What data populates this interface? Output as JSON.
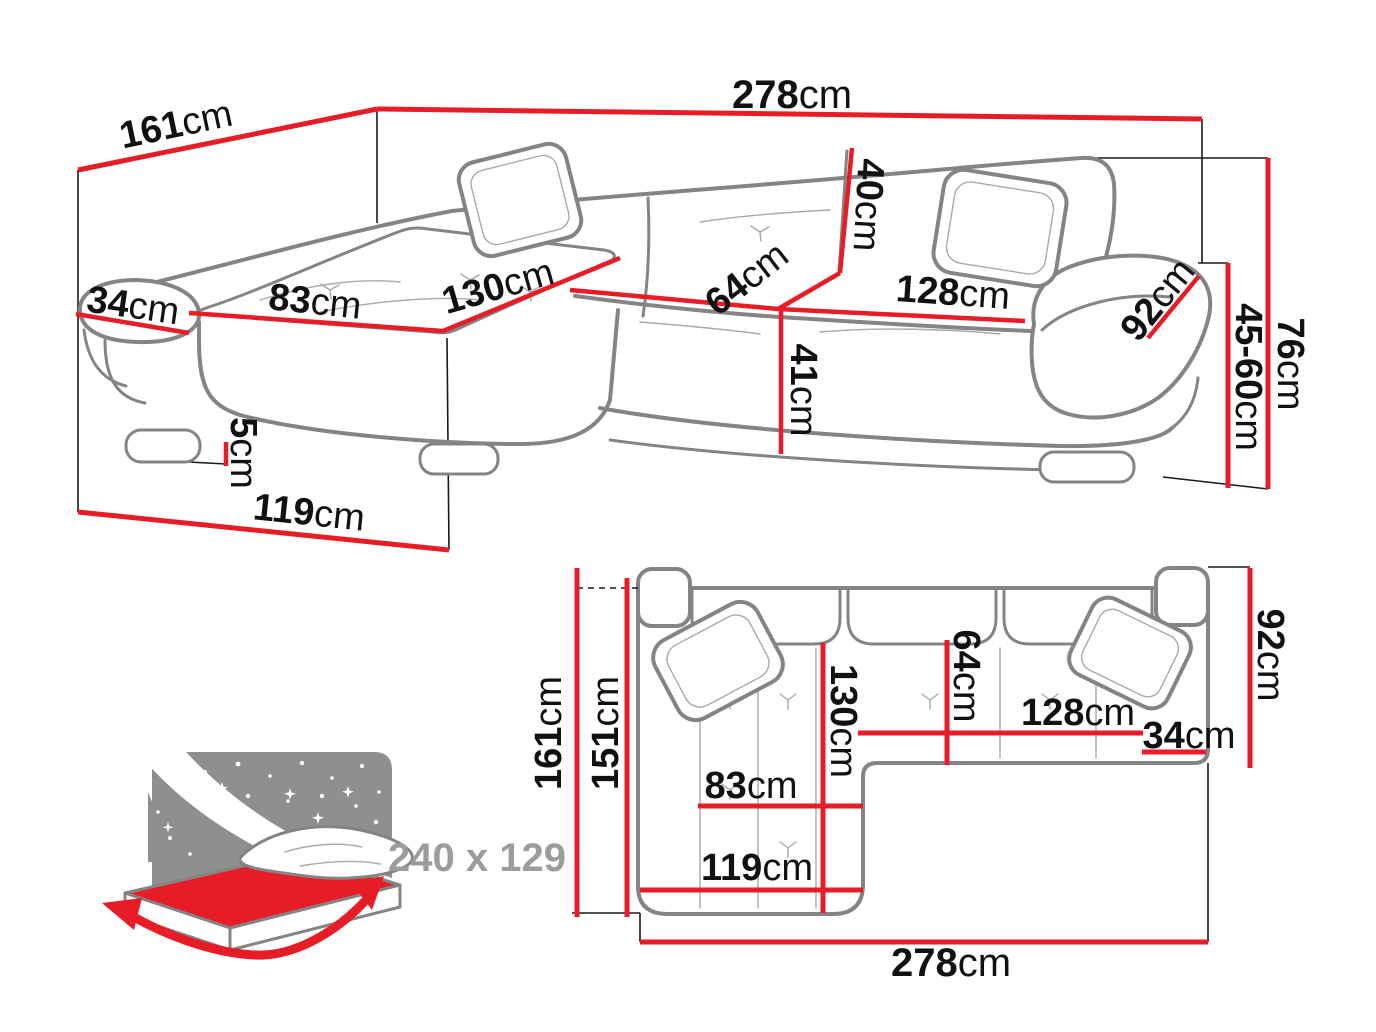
{
  "colors": {
    "dimension_red": "#e81c26",
    "sofa_outline_gray": "#848484",
    "detail_gray": "#a9a9a9",
    "line_black": "#1a1a1a",
    "label_black": "#111111",
    "icon_gray": "#8f8f8f",
    "icon_text_gray": "#9c9c9c",
    "background": "#ffffff"
  },
  "perspective_view": {
    "description": "corner sofa perspective drawing with dimensions",
    "dims": [
      {
        "id": "total-width",
        "value": "278",
        "unit": "cm"
      },
      {
        "id": "total-depth",
        "value": "161",
        "unit": "cm"
      },
      {
        "id": "armrest-width",
        "value": "34",
        "unit": "cm"
      },
      {
        "id": "chaise-seat-width",
        "value": "83",
        "unit": "cm"
      },
      {
        "id": "chaise-length",
        "value": "130",
        "unit": "cm"
      },
      {
        "id": "backrest-height",
        "value": "40",
        "unit": "cm"
      },
      {
        "id": "fold-depth",
        "value": "64",
        "unit": "cm"
      },
      {
        "id": "seat-width",
        "value": "128",
        "unit": "cm"
      },
      {
        "id": "armrest-length",
        "value": "92",
        "unit": "cm"
      },
      {
        "id": "total-height",
        "value": "76",
        "unit": "cm"
      },
      {
        "id": "seat-height-range",
        "value": "45-60",
        "unit": "cm"
      },
      {
        "id": "seat-height",
        "value": "41",
        "unit": "cm"
      },
      {
        "id": "leg-height",
        "value": "5",
        "unit": "cm"
      },
      {
        "id": "chaise-floor-length",
        "value": "119",
        "unit": "cm"
      }
    ]
  },
  "plan_view": {
    "description": "corner sofa top-down plan with dimensions",
    "dims": [
      {
        "id": "total-depth",
        "value": "161",
        "unit": "cm"
      },
      {
        "id": "chaise-depth",
        "value": "151",
        "unit": "cm"
      },
      {
        "id": "chaise-length",
        "value": "130",
        "unit": "cm"
      },
      {
        "id": "fold-depth",
        "value": "64",
        "unit": "cm"
      },
      {
        "id": "seat-width",
        "value": "128",
        "unit": "cm"
      },
      {
        "id": "armrest-width",
        "value": "34",
        "unit": "cm"
      },
      {
        "id": "armrest-length",
        "value": "92",
        "unit": "cm"
      },
      {
        "id": "chaise-seat-width",
        "value": "83",
        "unit": "cm"
      },
      {
        "id": "chaise-floor-length",
        "value": "119",
        "unit": "cm"
      },
      {
        "id": "total-width",
        "value": "278",
        "unit": "cm"
      }
    ]
  },
  "bed_icon": {
    "description": "sleeping function icon with fold-out bed size",
    "label": "240 x 129"
  }
}
